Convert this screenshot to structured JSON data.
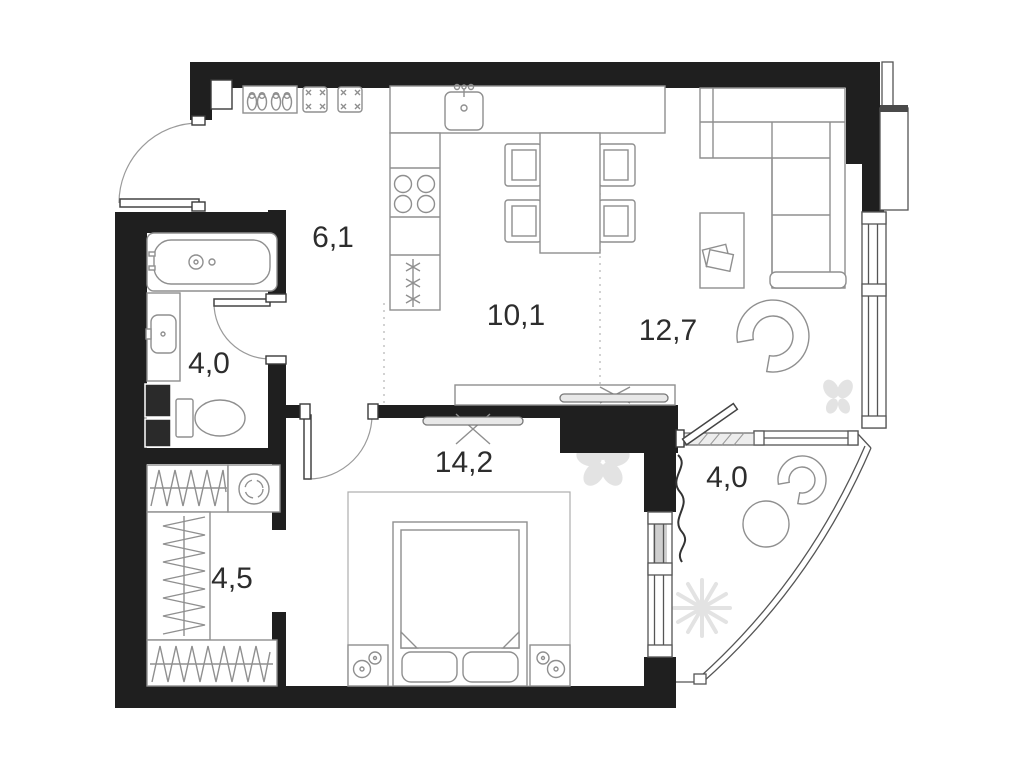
{
  "colors": {
    "wall": "#1f1f1f",
    "furniture_line": "#8f8f8f",
    "window_line": "#555555",
    "decor": "#e3e3e3",
    "label": "#2d2d2d",
    "background": "#ffffff"
  },
  "rooms": [
    {
      "id": "hallway",
      "area": "6,1"
    },
    {
      "id": "kitchen",
      "area": "10,1"
    },
    {
      "id": "living-room",
      "area": "12,7"
    },
    {
      "id": "bathroom",
      "area": "4,0"
    },
    {
      "id": "bedroom",
      "area": "14,2"
    },
    {
      "id": "balcony",
      "area": "4,0"
    },
    {
      "id": "wardrobe",
      "area": "4,5"
    }
  ],
  "fixtures": [
    "entrance-door",
    "shoe-cabinet",
    "poufs",
    "bathtub",
    "washbasin",
    "toilet",
    "laundry-shaft",
    "wardrobe-hangers",
    "washing-machine",
    "kitchen-sink",
    "stove",
    "fridge",
    "dining-table",
    "dining-chairs",
    "corner-sofa",
    "coffee-table",
    "lounge-chair",
    "tv-console",
    "tv",
    "bed",
    "nightstands",
    "carpet",
    "balcony-table",
    "balcony-chair",
    "flower-decor",
    "butterfly-decor",
    "plant-decor"
  ]
}
